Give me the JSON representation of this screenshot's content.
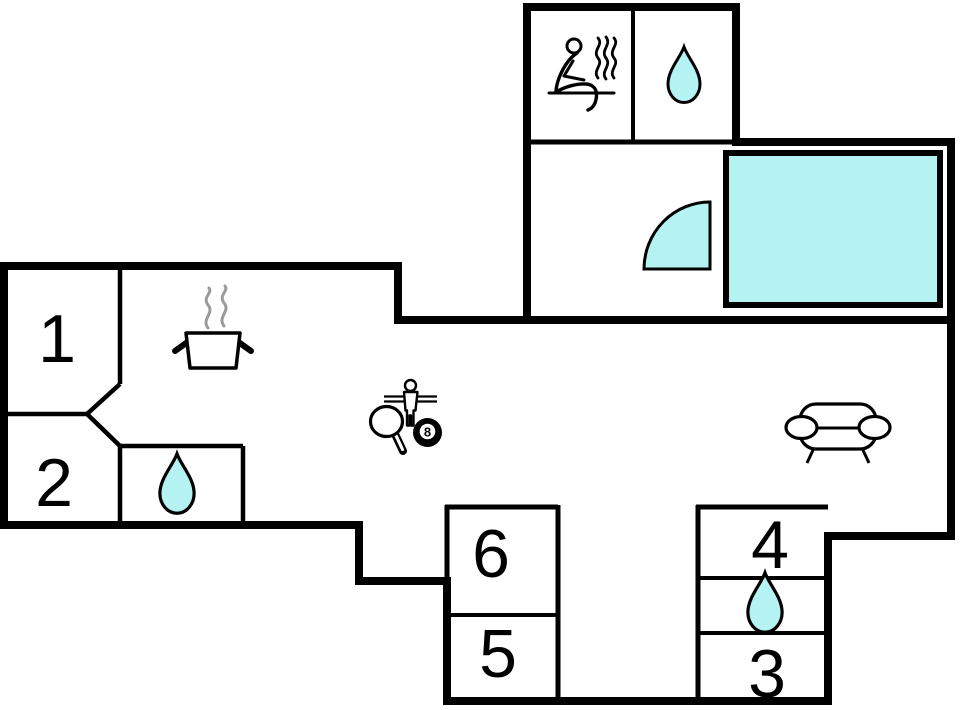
{
  "plan": {
    "type": "floor-plan",
    "rooms": [
      {
        "id": "room-1",
        "label": "1",
        "feature": "bedroom"
      },
      {
        "id": "room-2",
        "label": "2",
        "feature": "bedroom"
      },
      {
        "id": "room-3",
        "label": "3",
        "feature": "bedroom"
      },
      {
        "id": "room-4",
        "label": "4",
        "feature": "bedroom"
      },
      {
        "id": "room-5",
        "label": "5",
        "feature": "bedroom"
      },
      {
        "id": "room-6",
        "label": "6",
        "feature": "bedroom"
      }
    ],
    "ball_label": "8",
    "icons": [
      "sauna-icon",
      "water-drop-icon-top",
      "water-drop-icon-left",
      "water-drop-icon-right",
      "pool",
      "door-swing-icon",
      "cooking-pot-icon",
      "steam-icon",
      "foosball-player-icon",
      "table-tennis-paddle-icon",
      "billiard-8-ball-icon",
      "sofa-icon"
    ]
  },
  "colors": {
    "wall": "#000000",
    "water_fill": "#b5f2f2",
    "steam_gray": "#9a9a9a",
    "white": "#ffffff",
    "background": "#ffffff"
  }
}
